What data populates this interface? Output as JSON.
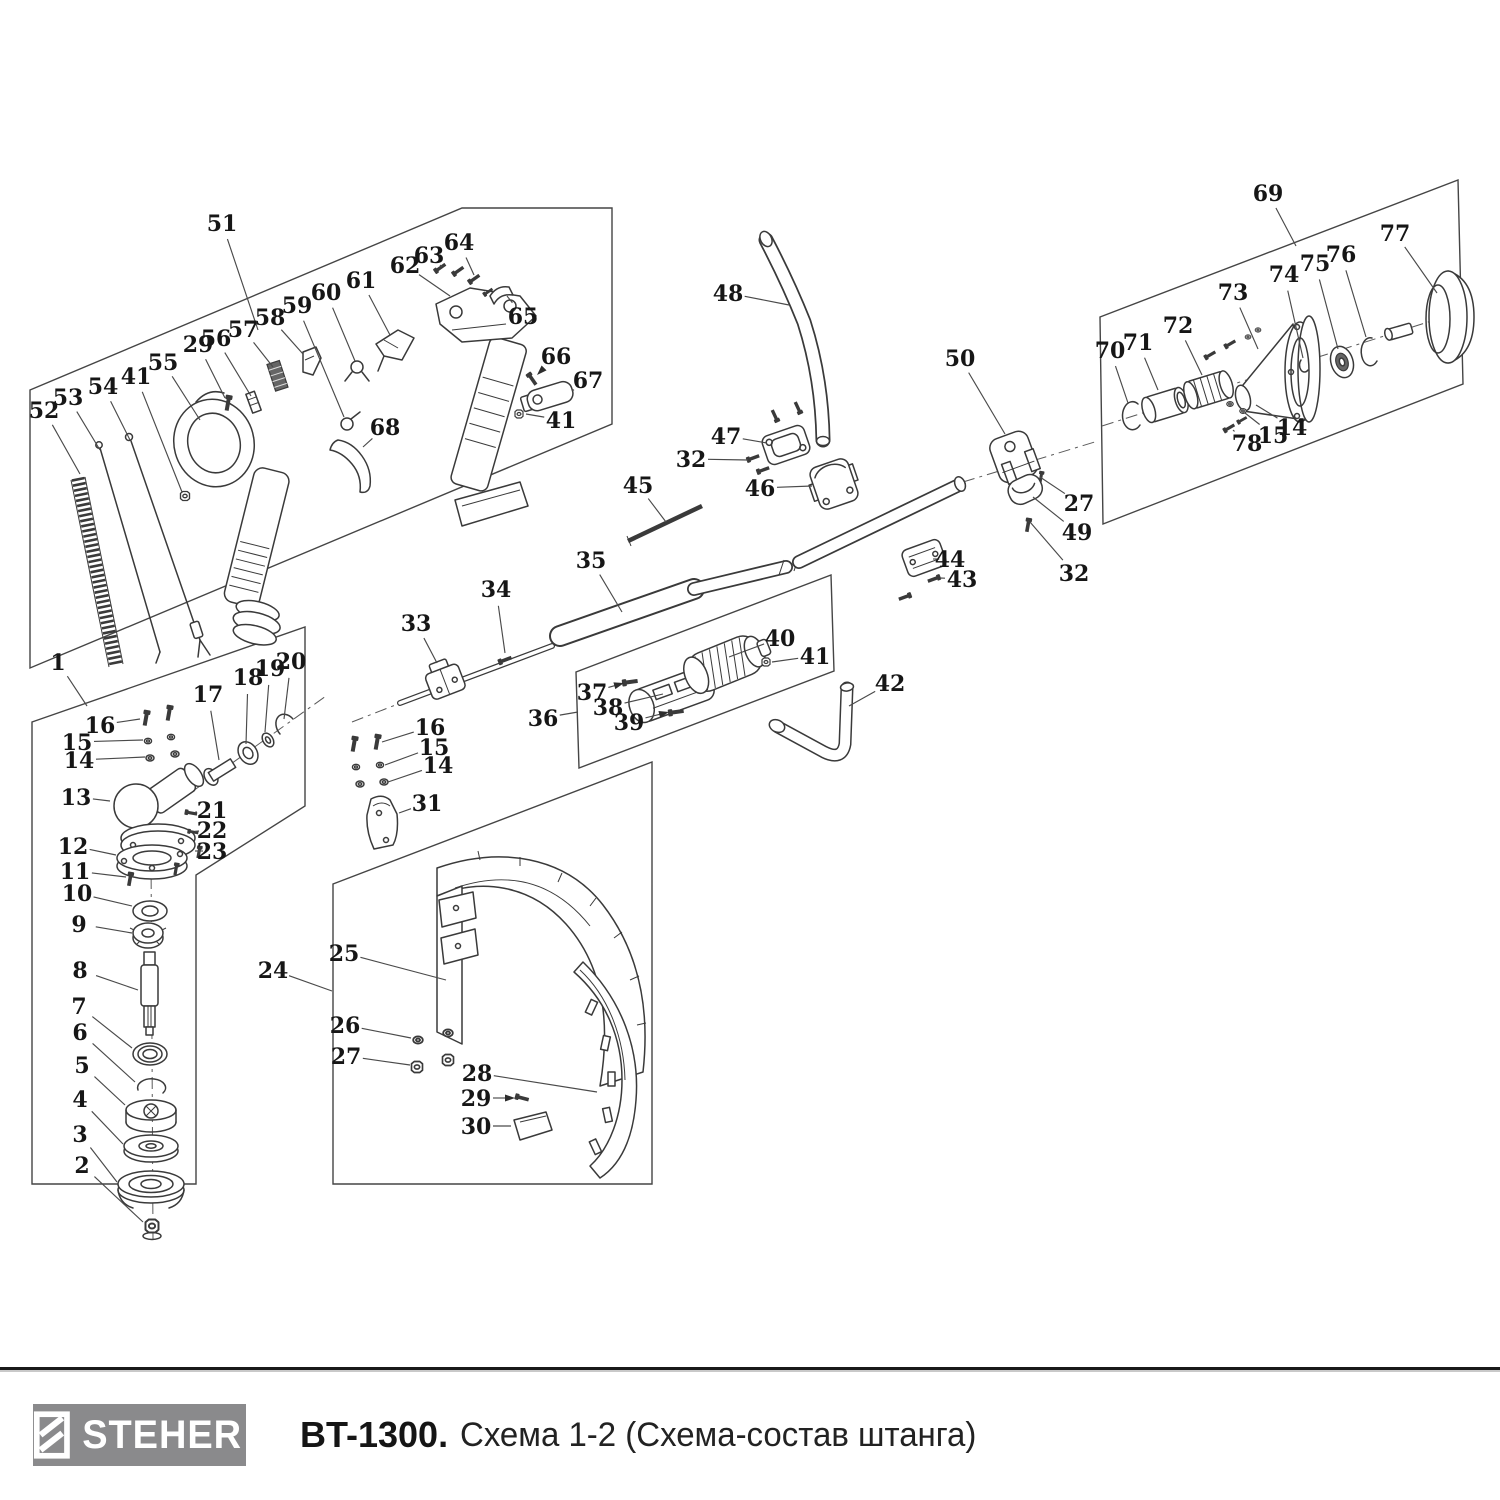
{
  "footer": {
    "brand": "STEHER",
    "model": "BT-1300.",
    "subtitle": "Схема 1-2 (Схема-состав штанга)"
  },
  "colors": {
    "line": "#3a3a3a",
    "label": "#161616",
    "logo_bg": "#8a8a8c"
  },
  "diagram": {
    "labels": [
      {
        "n": "51",
        "x": 222,
        "y": 223,
        "tx": 258,
        "ty": 330
      },
      {
        "n": "52",
        "x": 44,
        "y": 410,
        "tx": 80,
        "ty": 474
      },
      {
        "n": "53",
        "x": 68,
        "y": 397,
        "tx": 100,
        "ty": 450
      },
      {
        "n": "54",
        "x": 103,
        "y": 386,
        "tx": 130,
        "ty": 440
      },
      {
        "n": "41",
        "x": 136,
        "y": 376,
        "tx": 182,
        "ty": 492
      },
      {
        "n": "55",
        "x": 163,
        "y": 362,
        "tx": 200,
        "ty": 420
      },
      {
        "n": "29",
        "x": 198,
        "y": 344,
        "tx": 225,
        "ty": 398
      },
      {
        "n": "56",
        "x": 216,
        "y": 338,
        "tx": 251,
        "ty": 396
      },
      {
        "n": "57",
        "x": 243,
        "y": 329,
        "tx": 273,
        "ty": 367
      },
      {
        "n": "58",
        "x": 270,
        "y": 317,
        "tx": 303,
        "ty": 354
      },
      {
        "n": "59",
        "x": 297,
        "y": 305,
        "tx": 344,
        "ty": 417
      },
      {
        "n": "60",
        "x": 326,
        "y": 292,
        "tx": 355,
        "ty": 361
      },
      {
        "n": "61",
        "x": 361,
        "y": 280,
        "tx": 390,
        "ty": 335
      },
      {
        "n": "62",
        "x": 405,
        "y": 265,
        "tx": 450,
        "ty": 296
      },
      {
        "n": "63",
        "x": 429,
        "y": 255,
        "tx": 440,
        "ty": 265
      },
      {
        "n": "64",
        "x": 459,
        "y": 242,
        "tx": 474,
        "ty": 275
      },
      {
        "n": "65",
        "x": 523,
        "y": 316,
        "tx": 507,
        "ty": 296
      },
      {
        "n": "66",
        "x": 556,
        "y": 356,
        "tx": 537,
        "ty": 375,
        "arrow": true
      },
      {
        "n": "67",
        "x": 588,
        "y": 380,
        "tx": 572,
        "ty": 391
      },
      {
        "n": "68",
        "x": 385,
        "y": 427,
        "tx": 363,
        "ty": 447
      },
      {
        "n": "41",
        "x": 561,
        "y": 420,
        "tx": 526,
        "ty": 414
      },
      {
        "n": "1",
        "x": 58,
        "y": 662,
        "tx": 87,
        "ty": 706
      },
      {
        "n": "16",
        "x": 100,
        "y": 725,
        "tx": 140,
        "ty": 719
      },
      {
        "n": "15",
        "x": 77,
        "y": 742,
        "tx": 143,
        "ty": 740
      },
      {
        "n": "14",
        "x": 79,
        "y": 760,
        "tx": 145,
        "ty": 757
      },
      {
        "n": "17",
        "x": 208,
        "y": 694,
        "tx": 219,
        "ty": 760
      },
      {
        "n": "18",
        "x": 248,
        "y": 677,
        "tx": 246,
        "ty": 744
      },
      {
        "n": "19",
        "x": 270,
        "y": 668,
        "tx": 265,
        "ty": 732
      },
      {
        "n": "20",
        "x": 291,
        "y": 661,
        "tx": 284,
        "ty": 719
      },
      {
        "n": "13",
        "x": 76,
        "y": 797,
        "tx": 110,
        "ty": 801
      },
      {
        "n": "21",
        "x": 212,
        "y": 810,
        "tx": 197,
        "ty": 812
      },
      {
        "n": "22",
        "x": 212,
        "y": 830,
        "tx": 199,
        "ty": 831
      },
      {
        "n": "23",
        "x": 212,
        "y": 851,
        "tx": 203,
        "ty": 851
      },
      {
        "n": "12",
        "x": 73,
        "y": 846,
        "tx": 116,
        "ty": 855
      },
      {
        "n": "11",
        "x": 75,
        "y": 871,
        "tx": 126,
        "ty": 877
      },
      {
        "n": "10",
        "x": 77,
        "y": 893,
        "tx": 132,
        "ty": 906
      },
      {
        "n": "9",
        "x": 79,
        "y": 924,
        "tx": 132,
        "ty": 933
      },
      {
        "n": "8",
        "x": 80,
        "y": 970,
        "tx": 138,
        "ty": 990
      },
      {
        "n": "7",
        "x": 79,
        "y": 1006,
        "tx": 132,
        "ty": 1048
      },
      {
        "n": "6",
        "x": 80,
        "y": 1032,
        "tx": 135,
        "ty": 1082
      },
      {
        "n": "5",
        "x": 82,
        "y": 1065,
        "tx": 125,
        "ty": 1105
      },
      {
        "n": "4",
        "x": 80,
        "y": 1099,
        "tx": 123,
        "ty": 1144
      },
      {
        "n": "3",
        "x": 80,
        "y": 1134,
        "tx": 117,
        "ty": 1182
      },
      {
        "n": "2",
        "x": 82,
        "y": 1165,
        "tx": 143,
        "ty": 1222
      },
      {
        "n": "33",
        "x": 416,
        "y": 623,
        "tx": 437,
        "ty": 663
      },
      {
        "n": "34",
        "x": 496,
        "y": 589,
        "tx": 505,
        "ty": 653
      },
      {
        "n": "35",
        "x": 591,
        "y": 560,
        "tx": 622,
        "ty": 612
      },
      {
        "n": "45",
        "x": 638,
        "y": 485,
        "tx": 666,
        "ty": 522
      },
      {
        "n": "16",
        "x": 430,
        "y": 727,
        "tx": 382,
        "ty": 742
      },
      {
        "n": "15",
        "x": 434,
        "y": 747,
        "tx": 385,
        "ty": 765
      },
      {
        "n": "14",
        "x": 438,
        "y": 765,
        "tx": 388,
        "ty": 782
      },
      {
        "n": "31",
        "x": 427,
        "y": 803,
        "tx": 399,
        "ty": 813
      },
      {
        "n": "36",
        "x": 543,
        "y": 718,
        "tx": 578,
        "ty": 712
      },
      {
        "n": "37",
        "x": 592,
        "y": 692,
        "tx": 624,
        "ty": 683,
        "arrow": true
      },
      {
        "n": "38",
        "x": 608,
        "y": 707,
        "tx": 663,
        "ty": 694
      },
      {
        "n": "39",
        "x": 629,
        "y": 722,
        "tx": 669,
        "ty": 712,
        "arrow": true
      },
      {
        "n": "40",
        "x": 780,
        "y": 638,
        "tx": 729,
        "ty": 657
      },
      {
        "n": "41",
        "x": 815,
        "y": 656,
        "tx": 772,
        "ty": 662
      },
      {
        "n": "42",
        "x": 890,
        "y": 683,
        "tx": 849,
        "ty": 706
      },
      {
        "n": "48",
        "x": 728,
        "y": 293,
        "tx": 789,
        "ty": 305
      },
      {
        "n": "47",
        "x": 726,
        "y": 436,
        "tx": 767,
        "ty": 443
      },
      {
        "n": "32",
        "x": 691,
        "y": 459,
        "tx": 748,
        "ty": 460
      },
      {
        "n": "46",
        "x": 760,
        "y": 488,
        "tx": 812,
        "ty": 486
      },
      {
        "n": "44",
        "x": 950,
        "y": 559,
        "tx": 938,
        "ty": 559
      },
      {
        "n": "43",
        "x": 962,
        "y": 579,
        "tx": 940,
        "ty": 578
      },
      {
        "n": "50",
        "x": 960,
        "y": 358,
        "tx": 1005,
        "ty": 434
      },
      {
        "n": "27",
        "x": 1079,
        "y": 503,
        "tx": 1040,
        "ty": 477
      },
      {
        "n": "49",
        "x": 1077,
        "y": 532,
        "tx": 1033,
        "ty": 497
      },
      {
        "n": "32",
        "x": 1074,
        "y": 573,
        "tx": 1030,
        "ty": 522
      },
      {
        "n": "24",
        "x": 273,
        "y": 970,
        "tx": 332,
        "ty": 991
      },
      {
        "n": "25",
        "x": 344,
        "y": 953,
        "tx": 446,
        "ty": 980
      },
      {
        "n": "26",
        "x": 345,
        "y": 1025,
        "tx": 411,
        "ty": 1038
      },
      {
        "n": "27",
        "x": 346,
        "y": 1056,
        "tx": 410,
        "ty": 1065
      },
      {
        "n": "28",
        "x": 477,
        "y": 1073,
        "tx": 597,
        "ty": 1092
      },
      {
        "n": "29",
        "x": 476,
        "y": 1098,
        "tx": 515,
        "ty": 1098,
        "arrow": true
      },
      {
        "n": "30",
        "x": 476,
        "y": 1126,
        "tx": 511,
        "ty": 1126
      },
      {
        "n": "69",
        "x": 1268,
        "y": 193,
        "tx": 1296,
        "ty": 246
      },
      {
        "n": "70",
        "x": 1110,
        "y": 350,
        "tx": 1128,
        "ty": 403
      },
      {
        "n": "71",
        "x": 1138,
        "y": 342,
        "tx": 1158,
        "ty": 390
      },
      {
        "n": "72",
        "x": 1178,
        "y": 325,
        "tx": 1202,
        "ty": 375
      },
      {
        "n": "73",
        "x": 1233,
        "y": 292,
        "tx": 1258,
        "ty": 349
      },
      {
        "n": "74",
        "x": 1284,
        "y": 274,
        "tx": 1303,
        "ty": 358
      },
      {
        "n": "75",
        "x": 1315,
        "y": 263,
        "tx": 1338,
        "ty": 349
      },
      {
        "n": "76",
        "x": 1341,
        "y": 254,
        "tx": 1366,
        "ty": 337
      },
      {
        "n": "77",
        "x": 1395,
        "y": 233,
        "tx": 1437,
        "ty": 293
      },
      {
        "n": "78",
        "x": 1247,
        "y": 443,
        "tx": 1233,
        "ty": 430
      },
      {
        "n": "15",
        "x": 1273,
        "y": 435,
        "tx": 1245,
        "ty": 413
      },
      {
        "n": "14",
        "x": 1292,
        "y": 427,
        "tx": 1256,
        "ty": 405
      }
    ]
  }
}
